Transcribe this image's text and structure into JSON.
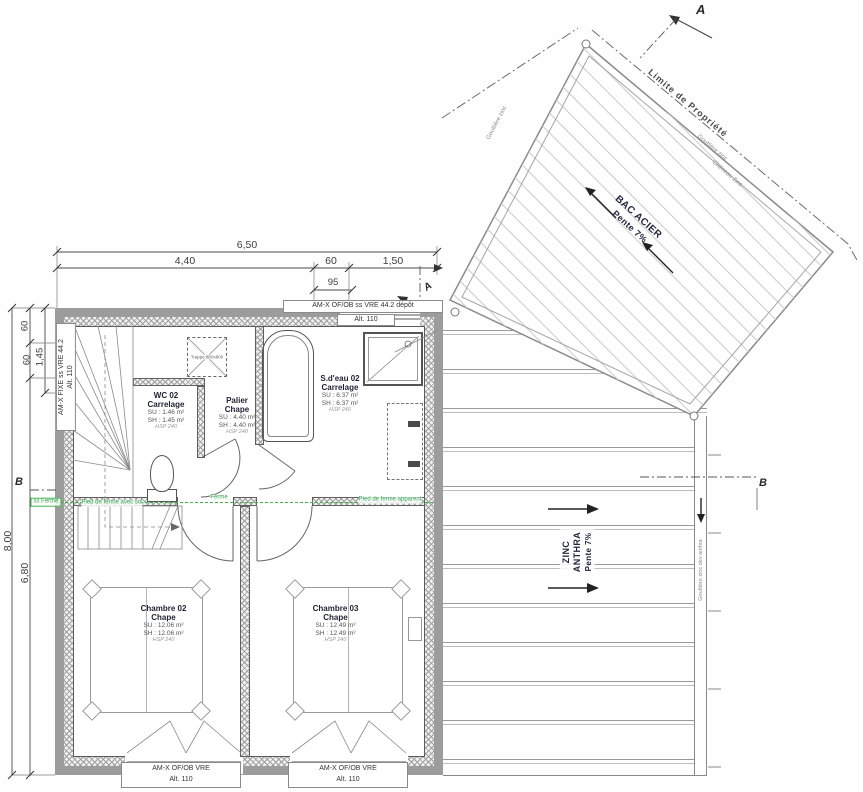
{
  "sections": {
    "a": "A",
    "b": "B"
  },
  "roof_bac": {
    "name": "BAC ACIER",
    "slope": "Pente 7%",
    "limite": "Limite de Propriété",
    "edge_left": "Gouttière zinc",
    "edge_right_1": "Gouttière zinc",
    "edge_right_2": "Chéneau Zinc"
  },
  "roof_zinc": {
    "name_1": "ZINC",
    "name_2": "ANTHRA",
    "slope": "Pente 7%",
    "gutter": "Gouttière zinc dev anthra"
  },
  "dims": {
    "total_w": "6,50",
    "w1": "4,40",
    "w2": "60",
    "w3": "1,50",
    "w_sub": "95",
    "total_h": "8,00",
    "h1": "60",
    "h2": "60",
    "h3": "1,45",
    "h4": "6,80"
  },
  "windows": {
    "top": {
      "l1": "AM-X OF/OB ss VRE 44.2 dépôt",
      "l2": "Alt. 110"
    },
    "left": {
      "l1": "AM-X FIXE ss VRE 44.2",
      "l2": "Alt. 110"
    },
    "b1": {
      "l1": "AM-X OF/OB VRE",
      "l2": "Alt. 110"
    },
    "b2": {
      "l1": "AM-X OF/OB VRE",
      "l2": "Alt. 110"
    }
  },
  "rooms": {
    "wc": {
      "name": "WC 02",
      "finish": "Carrelage",
      "su": "SU : 1.46 m²",
      "sh": "SH : 1.45 m²",
      "hsp": "HSP 240"
    },
    "palier": {
      "name": "Palier",
      "finish": "Chape",
      "su": "SU : 4.40 m²",
      "sh": "SH : 4.40 m²",
      "hsp": "HSP 240"
    },
    "sdeau": {
      "name": "S.d'eau 02",
      "finish": "Carrelage",
      "su": "SU : 6.37 m²",
      "sh": "SH : 6.37 m²",
      "hsp": "HSP 240"
    },
    "ch2": {
      "name": "Chambre 02",
      "finish": "Chape",
      "su": "SU : 12.06 m²",
      "sh": "SH : 12.06 m²",
      "hsp": "HSP 240"
    },
    "ch3": {
      "name": "Chambre 03",
      "finish": "Chape",
      "su": "SU : 12.49 m²",
      "sh": "SH : 12.49 m²",
      "hsp": "HSP 240"
    }
  },
  "doors": {
    "wc": "P: 63 x 2.04",
    "sdeau": "P: 73 x 2.04",
    "ch2": "P: 83 x 2.04",
    "ch3": "P: 83 x 2.04"
  },
  "annotations": {
    "trappe": "Trappe 800x800",
    "ferme_left": "ss Ferme",
    "ferme_mid1": "Pied de ferme avec sol",
    "ferme_mid2": "Ferme",
    "ferme_right": "Pied de ferme apparent"
  },
  "colors": {
    "wall": "#9c9c9c",
    "green": "#2fa24a",
    "accent_text": "#20283c"
  }
}
